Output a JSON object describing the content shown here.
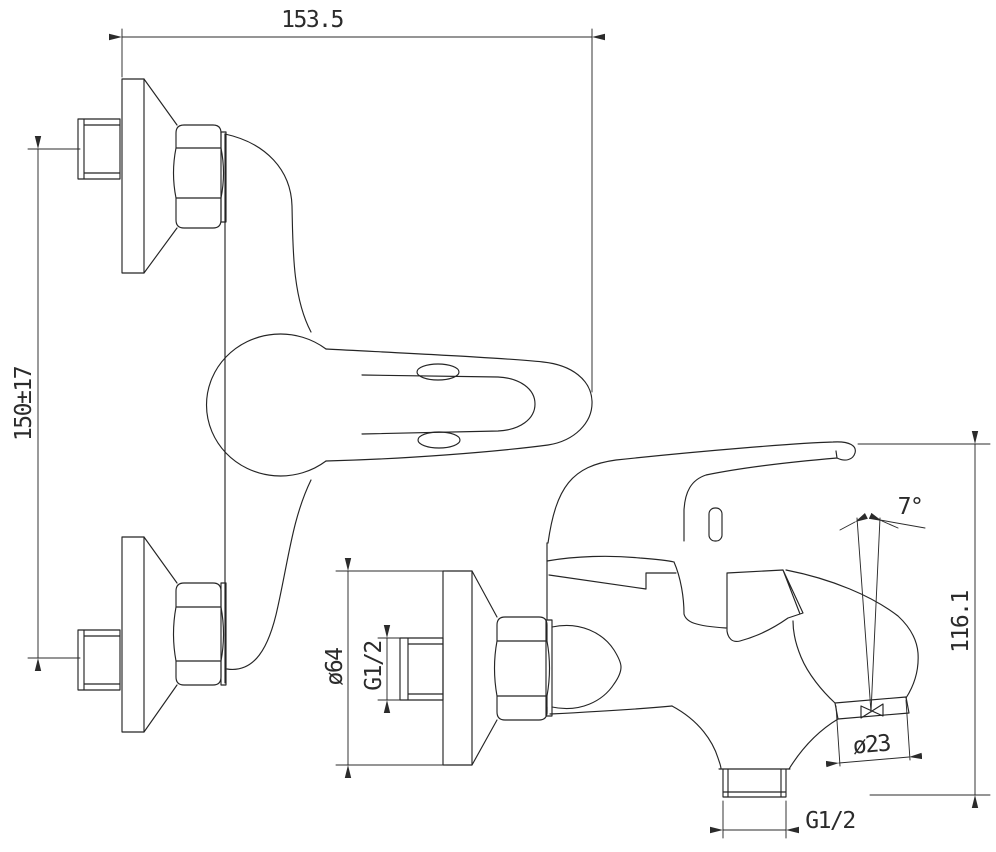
{
  "drawing": {
    "subject": "wall-mounted single-lever bath mixer faucet - orthographic technical drawing, two views",
    "background_color": "#ffffff",
    "line_color": "#252525",
    "views": [
      {
        "id": "top-view",
        "label": "plan view with two eccentric wall unions and lever handle"
      },
      {
        "id": "side-view",
        "label": "side elevation with wall union, handle and downward spout"
      }
    ],
    "dimensions": [
      {
        "id": "overall-depth",
        "label": "153.5"
      },
      {
        "id": "inlet-spacing",
        "label": "150±17"
      },
      {
        "id": "escutcheon-diameter",
        "label": "ø64"
      },
      {
        "id": "inlet-thread",
        "label": "G1/2"
      },
      {
        "id": "spout-angle",
        "label": "7°"
      },
      {
        "id": "overall-height",
        "label": "116.1"
      },
      {
        "id": "spout-end-diameter",
        "label": "ø23"
      },
      {
        "id": "outlet-thread",
        "label": "G1/2"
      }
    ]
  }
}
